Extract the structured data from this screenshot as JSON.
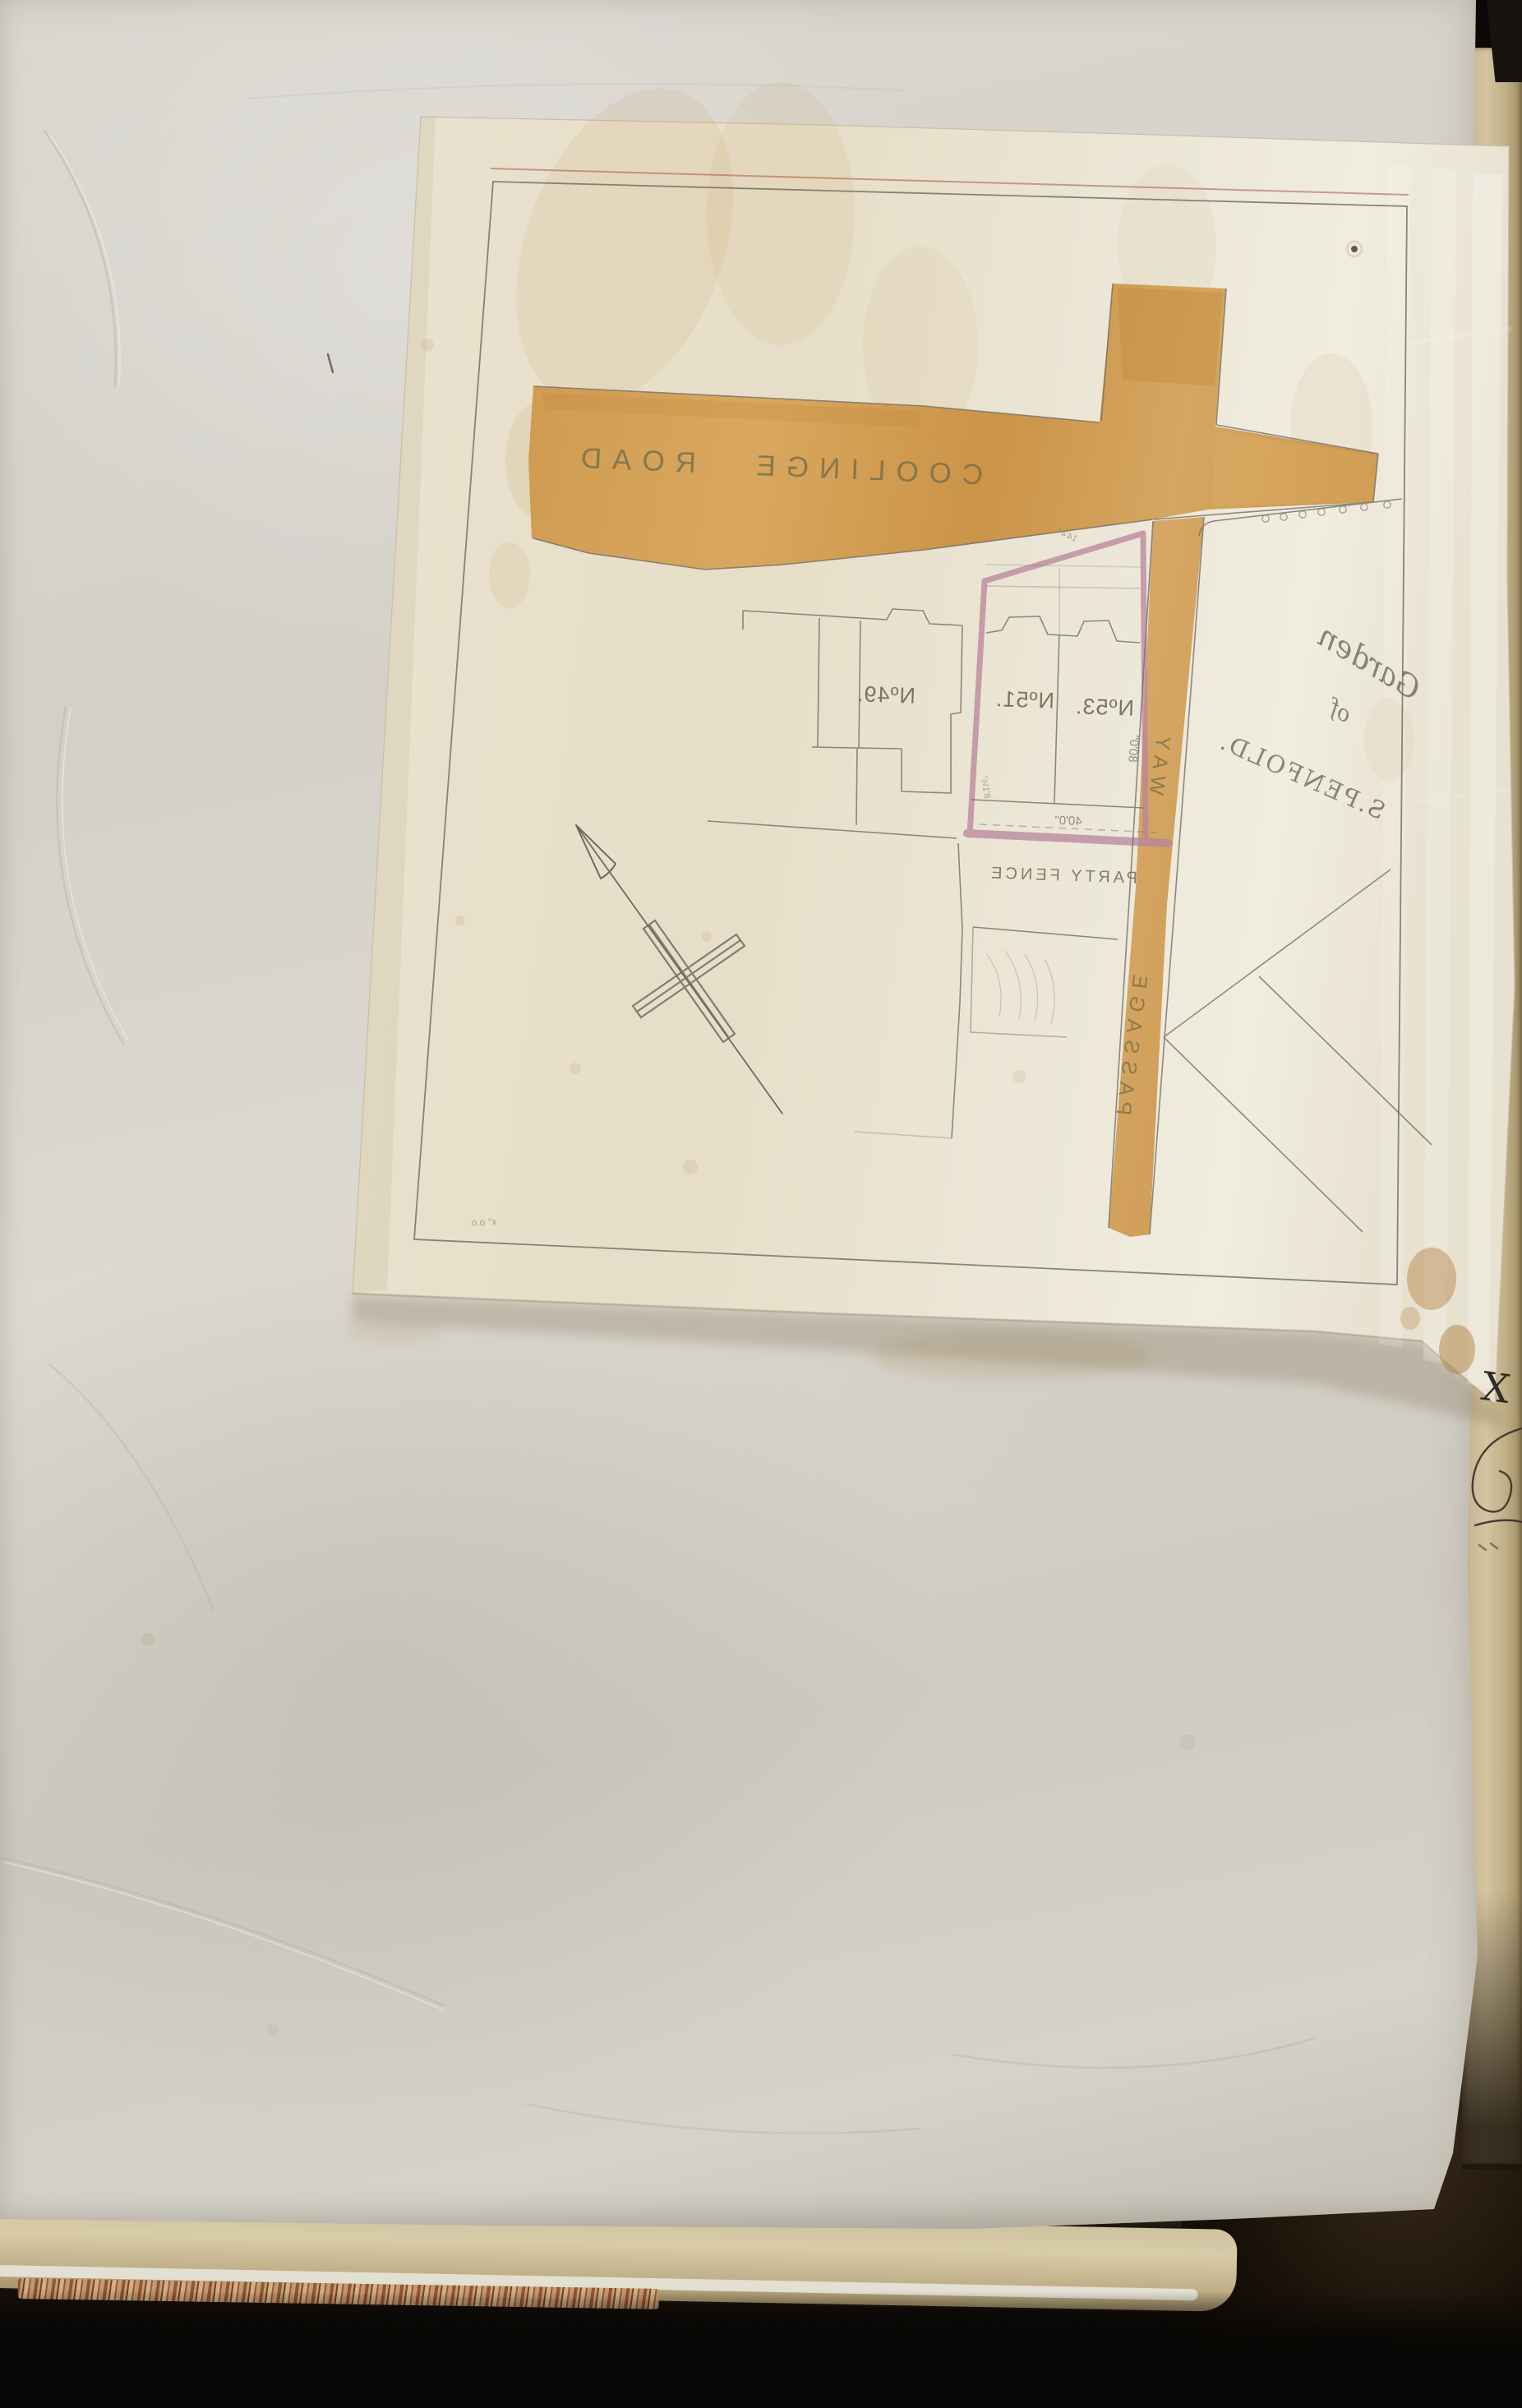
{
  "map": {
    "road_label": "COOLINGE ROAD",
    "passage_label": {
      "word1": "PASSAGE",
      "word2": "WAY"
    },
    "plots": {
      "n49": "Nº49.",
      "n51": "Nº51.",
      "n53": "Nº53."
    },
    "garden": {
      "line1": "Garden",
      "line2": "of",
      "line3": "S.PENFOLD."
    },
    "party_fence": "PARTY FENCE",
    "dimensions": {
      "rear_frontage": "40'0\"",
      "side_depth": "80'0\"",
      "side_small": "8'1½\"",
      "splay": "14'4\""
    },
    "corner_note": "x° o.o",
    "mirrored_note": "all plan lettering seen in mirror image through tracing paper"
  },
  "page_marks": {
    "margin_cross": "X"
  },
  "colors": {
    "road_wash": "#cf9748",
    "boundary_pink": "#b9849c",
    "pencil": "#74706a",
    "tracing_sheet": "#e9e2cf",
    "book_page": "#d6d3cc",
    "fore_edge": "#c9b892"
  }
}
